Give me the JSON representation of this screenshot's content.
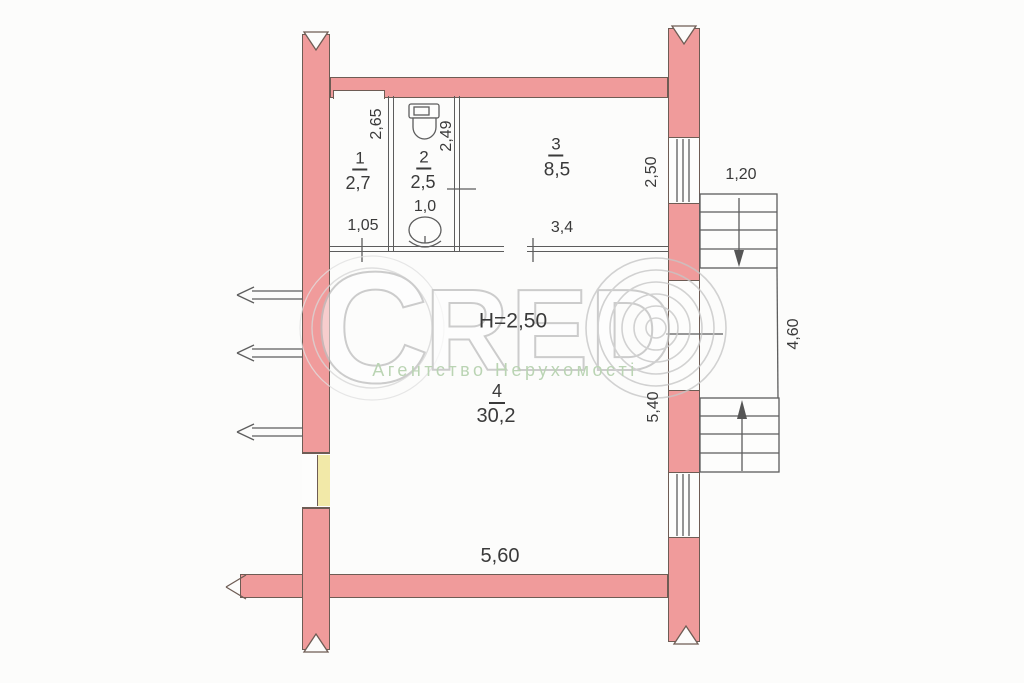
{
  "watermark": {
    "letter_c": "C",
    "letters_red": "RED",
    "symbol": "©",
    "subtitle": "Агентство Нерухомості"
  },
  "plan": {
    "ceiling_height": "H=2,50",
    "rooms": [
      {
        "number": "1",
        "area_m2": "2,7"
      },
      {
        "number": "2",
        "area_m2": "2,5"
      },
      {
        "number": "3",
        "area_m2": "8,5"
      },
      {
        "number": "4",
        "area_m2": "30,2"
      }
    ],
    "dimensions_m": [
      "2,65",
      "2,49",
      "2,50",
      "1,05",
      "1,0",
      "3,4",
      "1,20",
      "4,60",
      "5,40",
      "5,60"
    ]
  },
  "annotations": [
    {
      "name": "dim-2-65",
      "text": "2,65",
      "x": 377,
      "y": 124,
      "rot": -90,
      "size": 16
    },
    {
      "name": "dim-2-49",
      "text": "2,49",
      "x": 447,
      "y": 136,
      "rot": -90,
      "size": 16
    },
    {
      "name": "room-1-number",
      "text": "1",
      "x": 360,
      "y": 160,
      "rot": 0,
      "size": 17,
      "underline": true
    },
    {
      "name": "room-1-area",
      "text": "2,7",
      "x": 358,
      "y": 183,
      "rot": 0,
      "size": 18
    },
    {
      "name": "room-2-number",
      "text": "2",
      "x": 424,
      "y": 159,
      "rot": 0,
      "size": 17,
      "underline": true
    },
    {
      "name": "room-2-area",
      "text": "2,5",
      "x": 423,
      "y": 182,
      "rot": 0,
      "size": 18
    },
    {
      "name": "room-3-number",
      "text": "3",
      "x": 556,
      "y": 146,
      "rot": 0,
      "size": 17,
      "underline": true
    },
    {
      "name": "room-3-area",
      "text": "8,5",
      "x": 557,
      "y": 170,
      "rot": 0,
      "size": 19
    },
    {
      "name": "dim-1-05",
      "text": "1,05",
      "x": 363,
      "y": 226,
      "rot": 0,
      "size": 16
    },
    {
      "name": "dim-1-0",
      "text": "1,0",
      "x": 425,
      "y": 207,
      "rot": 0,
      "size": 16
    },
    {
      "name": "dim-3-4",
      "text": "3,4",
      "x": 562,
      "y": 228,
      "rot": 0,
      "size": 16
    },
    {
      "name": "dim-2-50-right",
      "text": "2,50",
      "x": 652,
      "y": 172,
      "rot": -90,
      "size": 16
    },
    {
      "name": "dim-1-20",
      "text": "1,20",
      "x": 741,
      "y": 175,
      "rot": 0,
      "size": 16
    },
    {
      "name": "dim-4-60",
      "text": "4,60",
      "x": 794,
      "y": 334,
      "rot": -90,
      "size": 16
    },
    {
      "name": "dim-5-40",
      "text": "5,40",
      "x": 654,
      "y": 407,
      "rot": -90,
      "size": 16
    },
    {
      "name": "ceiling-height-label",
      "text": "H=2,50",
      "x": 513,
      "y": 321,
      "rot": 0,
      "size": 21
    },
    {
      "name": "room-4-number",
      "text": "4",
      "x": 497,
      "y": 393,
      "rot": 0,
      "size": 18,
      "underline": true
    },
    {
      "name": "room-4-area",
      "text": "30,2",
      "x": 496,
      "y": 416,
      "rot": 0,
      "size": 20
    },
    {
      "name": "dim-5-60",
      "text": "5,60",
      "x": 500,
      "y": 556,
      "rot": 0,
      "size": 20
    }
  ]
}
